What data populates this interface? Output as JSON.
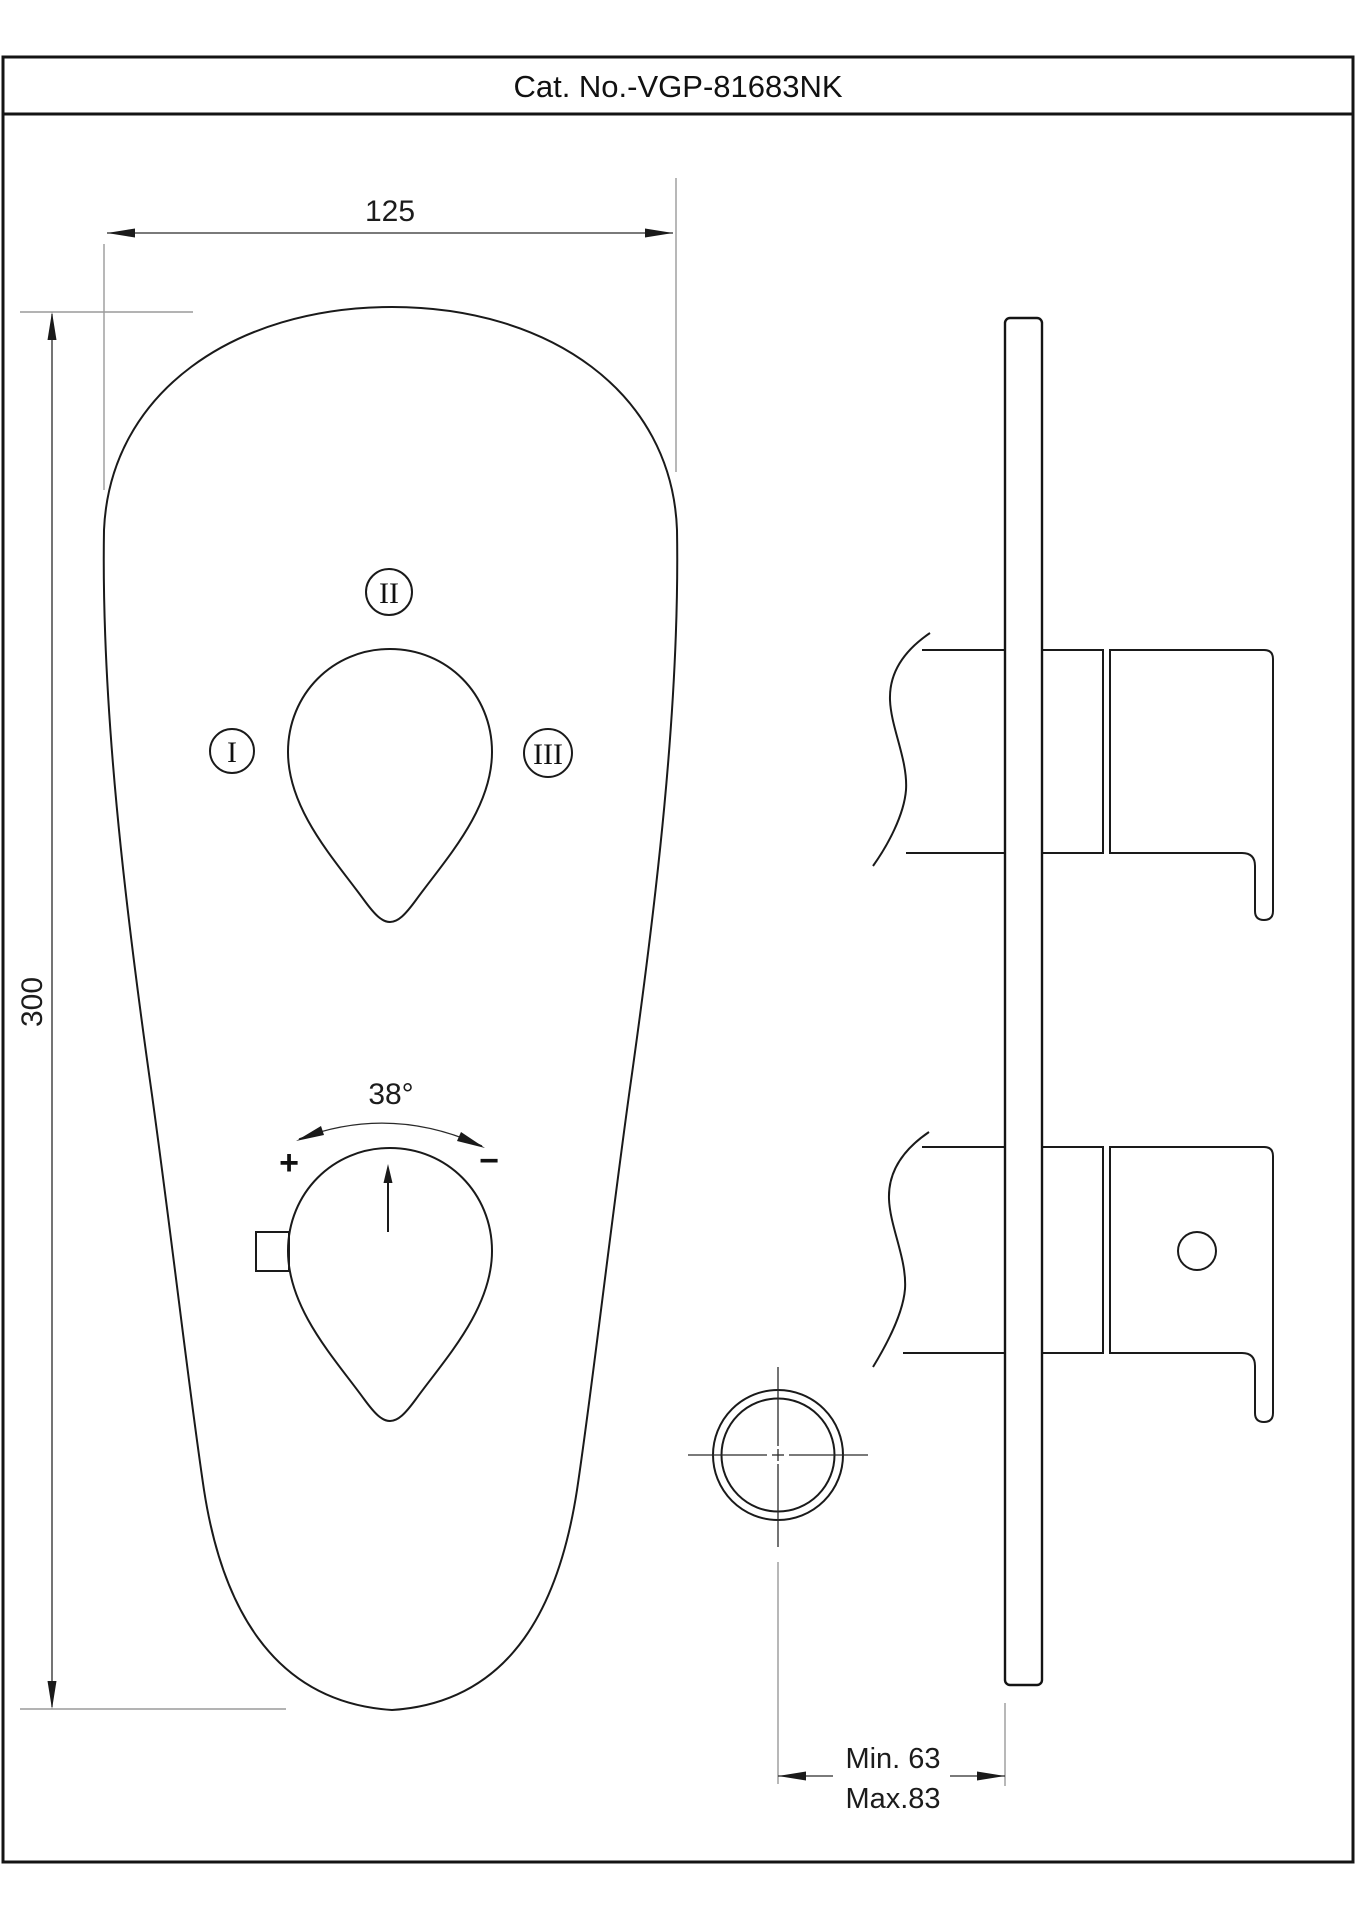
{
  "title": "Cat. No.-VGP-81683NK",
  "front_view": {
    "width_dim": "125",
    "height_dim": "300",
    "rotation_angle": "38°",
    "plus": "+",
    "minus": "−",
    "label_1": "I",
    "label_2": "II",
    "label_3": "III"
  },
  "side_view": {
    "depth_min": "Min. 63",
    "depth_max": "Max.83"
  },
  "colors": {
    "line": "#1a1a1a",
    "dimension_line": "#2a2a2a",
    "extension_line": "#9a9a9a",
    "background": "#ffffff"
  }
}
